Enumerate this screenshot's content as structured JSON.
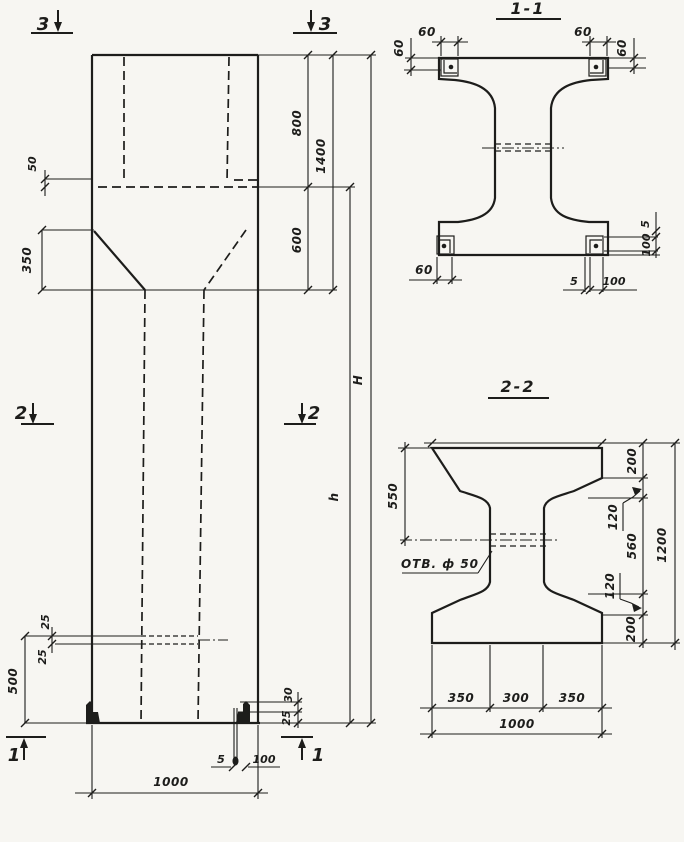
{
  "colors": {
    "ink": "#1d1d1b",
    "paper": "#f7f6f2"
  },
  "elevation": {
    "markers": {
      "top_left": "3",
      "top_right": "3",
      "mid_left": "2",
      "mid_right": "2",
      "bottom_left": "1",
      "bottom_right": "1"
    },
    "dims": {
      "ledge_50": "50",
      "taper_350": "350",
      "head_800": "800",
      "head_1400": "1400",
      "neck_600": "600",
      "total_H": "H",
      "shaft_h": "h",
      "slot_25_upper": "25",
      "slot_25_lower": "25",
      "base_500": "500",
      "foot_30": "30",
      "foot_25": "25",
      "foot_5": "5",
      "foot_100": "100",
      "width_1000": "1000"
    }
  },
  "section_1_1": {
    "title": "1-1",
    "dims": {
      "plate_top_left_width": "60",
      "plate_top_left_height": "60",
      "plate_top_right_width": "60",
      "plate_top_right_height": "60",
      "plate_bottom_left": "60",
      "bottom_5": "5",
      "bottom_100": "100",
      "side_5": "5",
      "side_100": "100"
    }
  },
  "section_2_2": {
    "title": "2-2",
    "hole_label": "ОТВ. ф 50",
    "dims": {
      "top_to_hole_550": "550",
      "flange_200_top": "200",
      "chamfer_120_top": "120",
      "web_560": "560",
      "chamfer_120_bottom": "120",
      "flange_200_bottom": "200",
      "height_1200": "1200",
      "bottom_350_left": "350",
      "bottom_300": "300",
      "bottom_350_right": "350",
      "bottom_1000": "1000"
    }
  }
}
